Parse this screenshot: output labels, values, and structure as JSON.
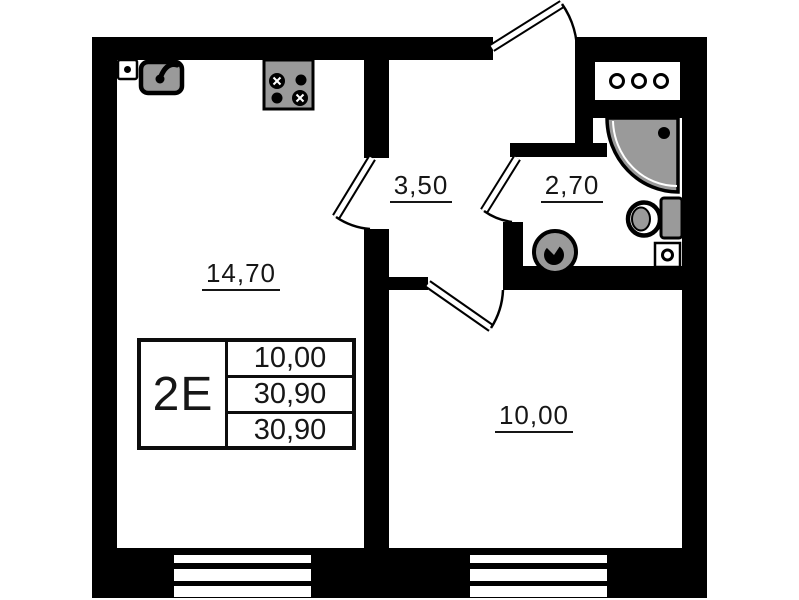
{
  "plan_title": "apartment-floor-plan",
  "stamp": {
    "type_label": "2E",
    "values": [
      "10,00",
      "30,90",
      "30,90"
    ]
  },
  "rooms": {
    "kitchen_living": {
      "name": "kitchen-living-room",
      "area": "14,70"
    },
    "hallway": {
      "name": "hallway",
      "area": "3,50"
    },
    "bathroom": {
      "name": "bathroom",
      "area": "2,70"
    },
    "bedroom": {
      "name": "room",
      "area": "10,00"
    }
  },
  "icons": [
    "power-outlet-icon",
    "kitchen-sink-icon",
    "stove-icon",
    "vent-grille-icon",
    "shower-cabin-icon",
    "shower-head-icon",
    "toilet-icon",
    "washbasin-icon",
    "drain-box-icon",
    "entrance-door-icon",
    "living-room-door-icon",
    "bathroom-door-icon",
    "bedroom-door-icon",
    "window-icon"
  ],
  "colors": {
    "wall": "#000000",
    "fixture_fill": "#9a9a9a",
    "background": "#ffffff",
    "text": "#161616"
  }
}
